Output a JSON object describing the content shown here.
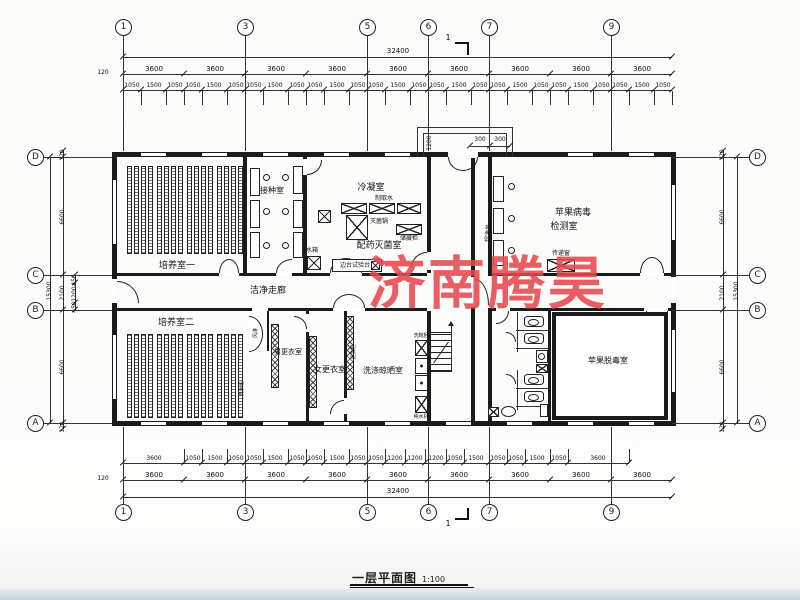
{
  "drawing": {
    "title": "一层平面图",
    "scale": "1:100",
    "watermark": "济南腾昊",
    "watermark_color": "#e8484f",
    "line_color": "#1b1b1b"
  },
  "axes": {
    "horizontal": [
      "1",
      "3",
      "5",
      "6",
      "7",
      "9"
    ],
    "vertical": [
      "D",
      "C",
      "B",
      "A"
    ],
    "section_mark": "1"
  },
  "dims": {
    "overall_width": "32400",
    "overall_height": "15300",
    "bay": "3600",
    "edge": "120",
    "top_detail": [
      "1050",
      "1500",
      "1050"
    ],
    "bottom_detail": [
      "3600",
      "1050",
      "1500",
      "1050",
      "1050",
      "1500",
      "1050",
      "1050",
      "1500",
      "1050",
      "1050",
      "1200",
      "1200",
      "1200",
      "1050",
      "1500",
      "1050",
      "1050",
      "1500",
      "1050",
      "3600"
    ],
    "left_segments": [
      "120",
      "6600",
      "2100",
      "6600",
      "120"
    ],
    "left_sub": [
      "450",
      "1200",
      "450"
    ],
    "porch_depth": "1200",
    "porch_side": "300"
  },
  "rooms": {
    "culture1": "培养室一",
    "culture2": "培养室二",
    "inoculation": "接种室",
    "condensation": "冷凝室",
    "medicine": "配药灭菌室",
    "corridor": "洁净走廊",
    "virus1": "苹果病毒",
    "virus2": "检测室",
    "detox": "苹果脱毒室",
    "men": "男更衣室",
    "women": "女更衣室",
    "washing": "洗涤晾晒室"
  },
  "equipment": {
    "sterilizer": "灭菌锅",
    "storage": "储藏柜",
    "bench": "边台试验台",
    "water_tank": "水箱",
    "water_maker": "制取水",
    "clean_bench": "超净台",
    "pass_window": "传递窗",
    "air_shower": "风淋",
    "boot_washer": "洗靴柜",
    "pure_water": "纯水机",
    "locker": "更衣柜",
    "hand_wash": "洗手池"
  }
}
